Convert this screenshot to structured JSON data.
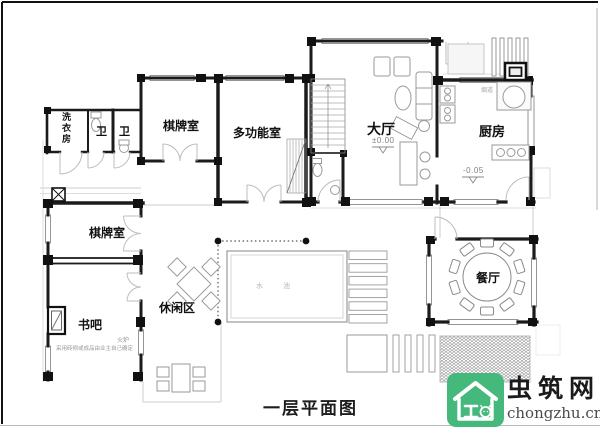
{
  "plan": {
    "title": "一层平面图",
    "rooms": {
      "laundry": "洗衣房",
      "wc_left": "卫",
      "wc_right": "卫",
      "chess_top": "棋牌室",
      "multi_function": "多功能室",
      "hall": "大厅",
      "kitchen": "厨房",
      "chess_west": "棋牌室",
      "book_bar": "书吧",
      "leisure": "休闲区",
      "dining": "餐厅",
      "pool": "水 池"
    },
    "elevations": {
      "hall": "±0.00",
      "kitchen": "-0.05"
    },
    "annotations": {
      "flue": "烟道",
      "stove": "火炉",
      "fireplace_note": "采用砖砌或成品由业主自己确定"
    }
  },
  "logo": {
    "name": "虫筑网",
    "domain": "chongzhu.cn",
    "brand_green": "#45b97c",
    "icon": "house-bug-icon"
  }
}
